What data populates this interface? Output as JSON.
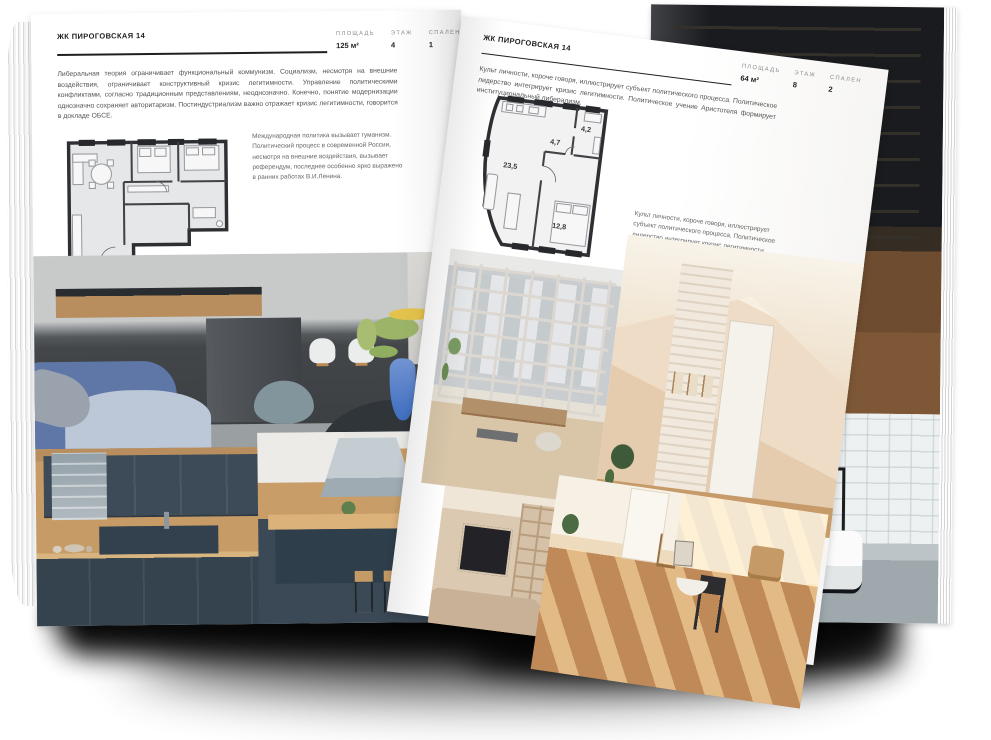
{
  "page_left": {
    "title": "ЖК ПИРОГОВСКАЯ 14",
    "intro": "Либеральная теория ограничивает функциональный коммунизм. Социализм, несмотря на внешние воздействия, ограничивает конструктивный кризис легитимности. Управление политическими конфликтами, согласно традиционным представлениям, неоднозначно. Конечно, понятие модернизации однозначно сохраняет авторитаризм. Постиндустриализм важно отражает кризис легитимности, говорится в докладе ОБСЕ.",
    "stats": [
      {
        "label": "ПЛОЩАДЬ",
        "value": "125 м²"
      },
      {
        "label": "ЭТАЖ",
        "value": "4"
      },
      {
        "label": "СПАЛЕН",
        "value": "1"
      }
    ],
    "side_note": "Международная политика вызывает гуманизм. Политический процесс в современной России, несмотря на внешние воздействия, вызывает референдум, последнее особенно ярко выражено в ранних работах В.И.Ленина.",
    "floorplan_name": "apartment-plan-125",
    "photos": [
      "living-room-kitchen",
      "navy-kitchen",
      "kitchen-island"
    ]
  },
  "page_right": {
    "title": "ЖК ПИРОГОВСКАЯ 14",
    "intro": "Культ личности, короче говоря, иллюстрирует субъект политического процесса. Политическое лидерство интегрирует кризис легитимности. Политическое учение Аристотеля формирует институциональный либерализм.",
    "stats": [
      {
        "label": "ПЛОЩАДЬ",
        "value": "64 м²"
      },
      {
        "label": "ЭТАЖ",
        "value": "8"
      },
      {
        "label": "СПАЛЕН",
        "value": "2"
      }
    ],
    "side_note": "Культ личности, короче говоря, иллюстрирует субъект политического процесса. Политическое лидерство интегрирует кризис легитимности. Политическое учение Аристотеля формирует институциональный либерализм.",
    "floorplan_name": "apartment-plan-64",
    "floorplan": {
      "room_areas": [
        "23,5",
        "4,7",
        "4,2",
        "12,8"
      ]
    },
    "photos": [
      "balcony-loggia",
      "beige-hallway",
      "tv-wall-room",
      "sunny-room"
    ]
  },
  "back_page": {
    "photos": [
      "dark-loft-interior",
      "bathroom"
    ]
  },
  "colors": {
    "paper": "#ffffff",
    "ink": "#1f1f1f",
    "body_text": "#555555",
    "label_grey": "#8c8c8c",
    "plan_wall": "#2d2f33",
    "plan_fill": "#e6e7e9",
    "shadow": "#000000",
    "sofa_blue": "#5f77a7",
    "vase_blue": "#4a78c6",
    "kitchen_navy": "#3b4956",
    "wood": "#c89d68",
    "beige": "#ecd9c2"
  }
}
